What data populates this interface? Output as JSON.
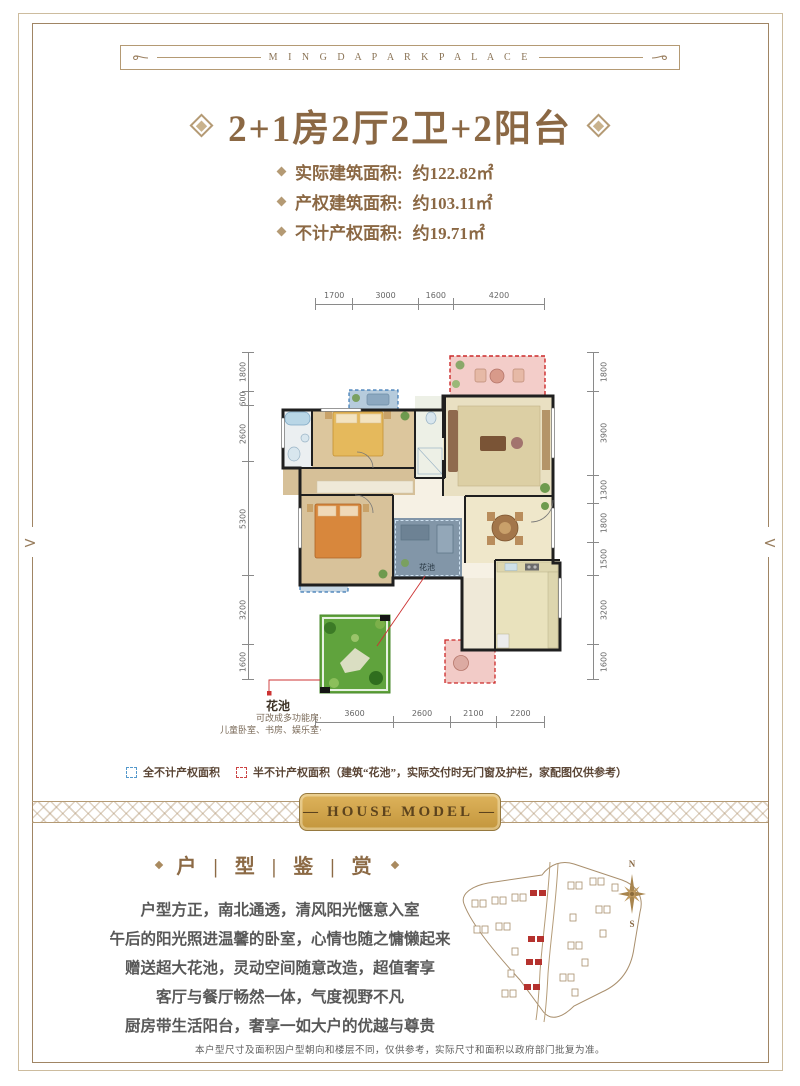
{
  "header": {
    "brand": "M I N G D A P A R K P A L A C E"
  },
  "nav": {
    "prev_arrow": ">",
    "next_arrow": "<"
  },
  "title": {
    "text": "2+1房2厅2卫+2阳台"
  },
  "specs": [
    {
      "label": "实际建筑面积:",
      "value": "约122.82㎡"
    },
    {
      "label": "产权建筑面积:",
      "value": "约103.11㎡"
    },
    {
      "label": "不计产权面积:",
      "value": "约19.71㎡"
    }
  ],
  "floorplan": {
    "dims_top": [
      "1700",
      "3000",
      "1600",
      "4200"
    ],
    "dims_left": [
      "1800",
      "600",
      "2600",
      "5300",
      "3200",
      "1600"
    ],
    "dims_right": [
      "1800",
      "3900",
      "1300",
      "1800",
      "1500",
      "3200",
      "1600"
    ],
    "dims_bottom": [
      "3600",
      "2600",
      "2100",
      "2200"
    ],
    "flower_pool_label": "花池",
    "callout_label": "花池",
    "note_line1": "可改成多功能房·",
    "note_line2": "儿童卧室、书房、娱乐室·"
  },
  "legend": [
    {
      "text": "全不计产权面积"
    },
    {
      "text": "半不计产权面积（建筑“花池”，实际交付时无门窗及护栏，家配图仅供参考）"
    }
  ],
  "ribbon": {
    "dash": "—",
    "label": "HOUSE MODEL"
  },
  "section": {
    "title": "户  |  型  |  鉴  |  赏"
  },
  "description": [
    "户型方正，南北通透，清风阳光惬意入室",
    "午后的阳光照进温馨的卧室，心情也随之慵懒起来",
    "赠送超大花池，灵动空间随意改造，超值奢享",
    "客厅与餐厅畅然一体，气度视野不凡",
    "厨房带生活阳台，奢享一如大户的优越与尊贵"
  ],
  "compass": {
    "north": "N",
    "south": "S"
  },
  "footer": {
    "disclaimer": "本户型尺寸及面积因户型朝向和楼层不同，仅供参考，实际尺寸和面积以政府部门批复为准。"
  },
  "colors": {
    "accent_gold": "#b49a74",
    "title_brown": "#8b6844",
    "plaque_gold": "#cfa04a",
    "red_dash": "#cc4444",
    "blue_dash": "#5599cc"
  }
}
